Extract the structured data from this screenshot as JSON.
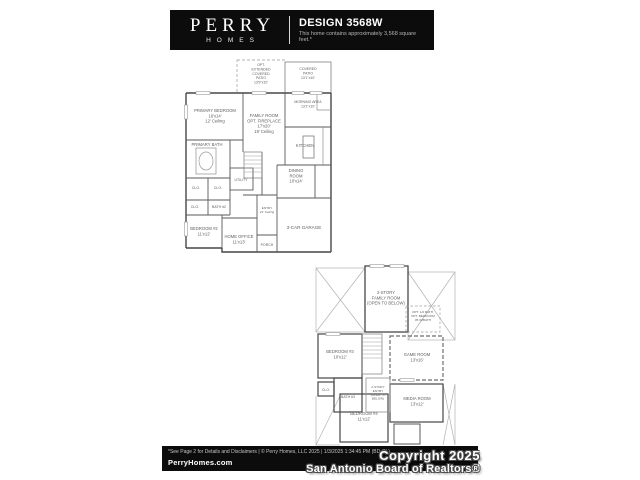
{
  "header": {
    "brand_name": "PERRY",
    "brand_sub": "HOMES",
    "design_title": "DESIGN 3568W",
    "design_subtitle": "This home contains approximately 3,568 square feet.*"
  },
  "first_floor": {
    "rooms": {
      "ext_patio": [
        "OPT.",
        "EXTENDED",
        "COVERED",
        "PATIO",
        "13'9\"x10'"
      ],
      "covered_patio": [
        "COVERED",
        "PATIO",
        "13'1\"x10'"
      ],
      "morning_area": [
        "MORNING AREA",
        "13'1\"x10'"
      ],
      "primary_bedroom": [
        "PRIMARY BEDROOM",
        "16'x14'",
        "12' Ceiling"
      ],
      "family_room": [
        "FAMILY ROOM",
        "OPT. FIREPLACE",
        "17'x20'",
        "19' Ceiling"
      ],
      "kitchen": [
        "KITCHEN"
      ],
      "primary_bath": [
        "PRIMARY BATH"
      ],
      "dining_room": [
        "DINING",
        "ROOM",
        "10'x14'"
      ],
      "clo_1": [
        "CLO."
      ],
      "clo_2": [
        "CLO."
      ],
      "clo_3": [
        "CLO."
      ],
      "utility": [
        "UTILITY"
      ],
      "bath_2": [
        "BATH #2"
      ],
      "entry": [
        "ENTRY",
        "21' Ceiling"
      ],
      "bedroom_2": [
        "BEDROOM #2",
        "11'x12'"
      ],
      "home_office": [
        "HOME OFFICE",
        "11'x13'"
      ],
      "porch": [
        "PORCH"
      ],
      "garage": [
        "3-CAR GARAGE"
      ]
    }
  },
  "second_floor": {
    "rooms": {
      "family_room_open": [
        "2-STORY",
        "FAMILY ROOM",
        "(OPEN TO BELOW)"
      ],
      "opt_bed5": [
        "OPT. 1/2 BATH,",
        "OPT. BEDROOM",
        "#5 W/BATH"
      ],
      "bedroom_3": [
        "BEDROOM #3",
        "10'x12'"
      ],
      "game_room": [
        "GAME ROOM",
        "13'x16'"
      ],
      "media_room": [
        "MEDIA ROOM",
        "13'x12'"
      ],
      "bedroom_4": [
        "BEDROOM #4",
        "11'x12'"
      ],
      "entry_open": [
        "2-STORY",
        "ENTRY",
        "(OPEN TO",
        "BELOW)"
      ],
      "clo_1": [
        "CLO."
      ],
      "bath_3": [
        "BATH #3"
      ]
    }
  },
  "footer": {
    "disclaimer": "*See Page 2 for Details and Disclaimers | © Perry Homes, LLC 2025 | 1/3/2025 1:34:45 PM (BD-CL)",
    "website": "PerryHomes.com"
  },
  "watermark": {
    "line1": "Copyright 2025",
    "line2": "San Antonio Board of Realtors®"
  },
  "colors": {
    "bar_bg": "#0c0c0c",
    "wall": "#474747",
    "light_line": "#9a9a9a",
    "label_text": "#5f5f5f",
    "white": "#ffffff"
  }
}
